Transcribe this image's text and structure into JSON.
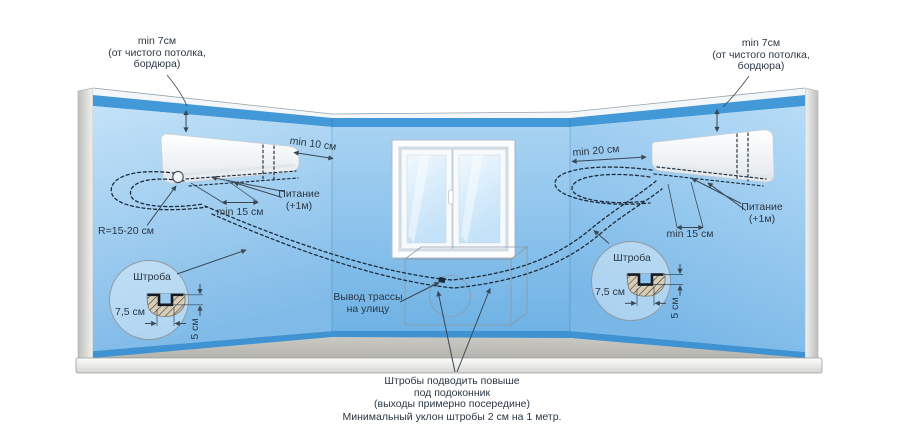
{
  "diagram": {
    "labels": {
      "ceiling_clearance": {
        "line1": "min 7см",
        "line2": "(от чистого потолка,",
        "line3": "бордюра)"
      },
      "left_side_clearance": "min 10 см",
      "right_side_clearance": "min 20 см",
      "trassa_offset": "min 15 см",
      "power": {
        "line1": "Питание",
        "line2": "(+1м)"
      },
      "bend_radius": "R=15-20 см",
      "groove": {
        "title": "Штроба",
        "width": "7,5 см",
        "depth": "5 см"
      },
      "outlet": {
        "line1": "Вывод трассы",
        "line2": "на улицу"
      },
      "notes": {
        "line1": "Штробы подводить повыше",
        "line2": "под подоконник",
        "line3": "(выходы примерно посередине)",
        "line4": "Минимальный уклон штробы 2 см на 1 метр."
      }
    },
    "colors": {
      "border_blue": "#4398d8",
      "baseboard_blue": "#3f93d3",
      "wall_light": "#c3e2f8",
      "wall_deep": "#6fb2e5",
      "floor_gray": "#a7a6a1",
      "ledge_gray": "#d5d5d2",
      "line_dark": "#3a4754",
      "trassa_dark": "#1e2d3c",
      "hatch_fill": "#d8cdb9",
      "text": "#2b3744"
    }
  }
}
